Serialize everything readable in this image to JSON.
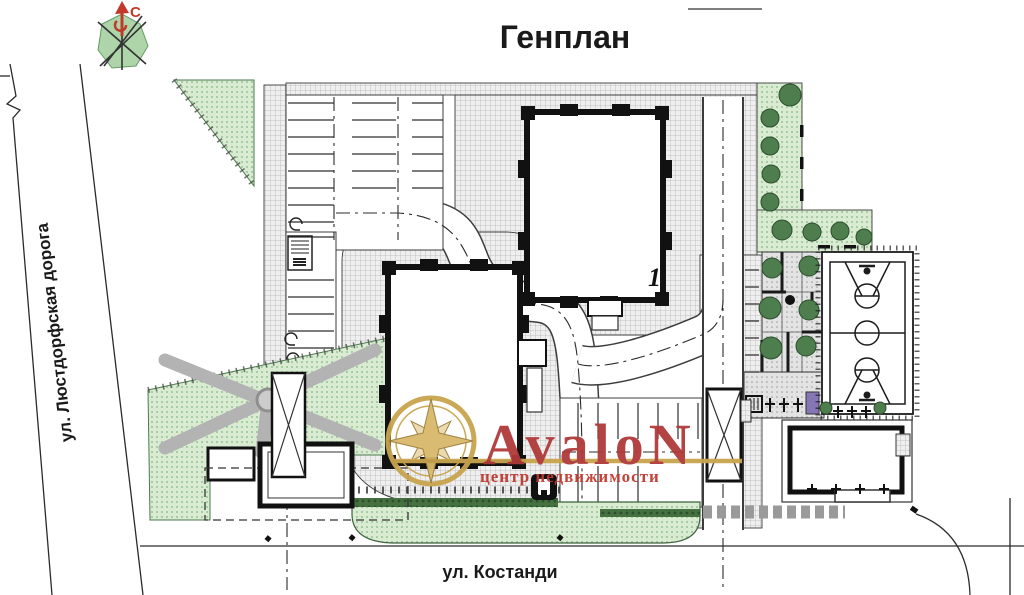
{
  "title": "Генплан",
  "compass": {
    "north_label": "С"
  },
  "streets": {
    "left_street": "ул. Люстдорфская дорога",
    "bottom_street": "ул. Костанди"
  },
  "site": {
    "building1_label": "1"
  },
  "watermark": {
    "brand": "AvaloN",
    "tagline": "центр недвижимости"
  },
  "colors": {
    "brand_red": "#b03a3a",
    "tagline_red": "#c03a30",
    "brand_gold": "#c9a44c",
    "north_red": "#c0392b"
  }
}
